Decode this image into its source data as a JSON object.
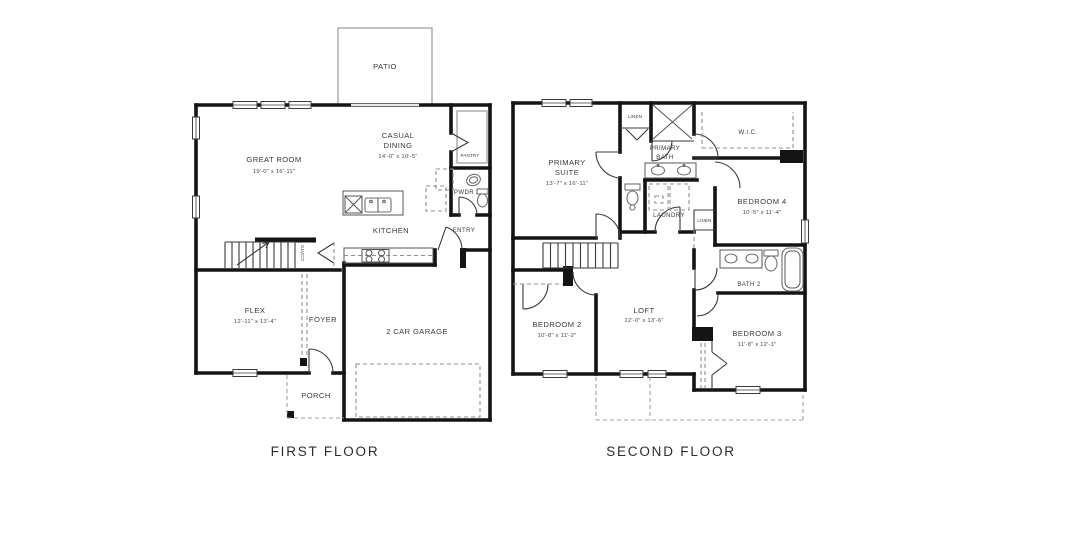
{
  "page": {
    "background": "#ffffff",
    "wall_color": "#141414",
    "text_color": "#3a3a3a"
  },
  "floor1": {
    "title": "FIRST FLOOR",
    "patio": "PATIO",
    "great_room": {
      "name": "GREAT ROOM",
      "dims": "19'-0\" x 16'-11\""
    },
    "casual_dining": {
      "line1": "CASUAL",
      "line2": "DINING",
      "dims": "14'-0\" x 10'-5\""
    },
    "pantry": "PANTRY",
    "pwdr": "PWDR",
    "kitchen": "KITCHEN",
    "entry": "ENTRY",
    "coats": "COATS",
    "flex": {
      "name": "FLEX",
      "dims": "12'-11\" x 13'-4\""
    },
    "foyer": "FOYER",
    "garage": "2 CAR GARAGE",
    "porch": "PORCH"
  },
  "floor2": {
    "title": "SECOND FLOOR",
    "primary_suite": {
      "line1": "PRIMARY",
      "line2": "SUITE",
      "dims": "13'-7\" x 16'-11\""
    },
    "linen_top": "LINEN",
    "primary_bath": {
      "line1": "PRIMARY",
      "line2": "BATH"
    },
    "wic": "W.I.C.",
    "bedroom4": {
      "name": "BEDROOM 4",
      "dims": "10'-5\" x 11'-4\""
    },
    "laundry": "LAUNDRY",
    "linen_mid": "LINEN",
    "bath2": "BATH 2",
    "bedroom2": {
      "name": "BEDROOM 2",
      "dims": "10'-8\" x 11'-2\""
    },
    "loft": {
      "name": "LOFT",
      "dims": "12'-0\" x 13'-6\""
    },
    "bedroom3": {
      "name": "BEDROOM 3",
      "dims": "11'-8\" x 12'-1\""
    }
  }
}
